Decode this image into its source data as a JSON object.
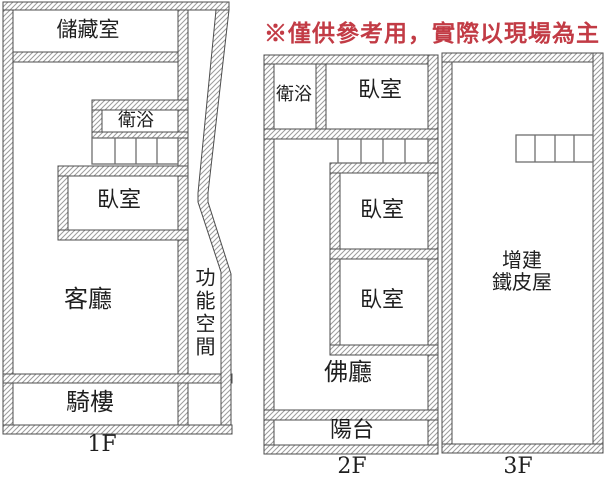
{
  "disclaimer": {
    "text": "※僅供參考用，實際以現場為主",
    "color": "#C23B45"
  },
  "colors": {
    "wall_outline": "#4d4d4d",
    "wall_hatch": "#9c9c9c",
    "stair_line": "#6e6e6e",
    "label_text": "#1f1f1f",
    "background": "#ffffff"
  },
  "floors": [
    {
      "label": "1F",
      "rooms": {
        "storage": "儲藏室",
        "bathroom": "衛浴",
        "bedroom": "臥室",
        "living": "客廳",
        "functional": "功能空間",
        "arcade": "騎樓"
      }
    },
    {
      "label": "2F",
      "rooms": {
        "bathroom": "衛浴",
        "bedroom_top": "臥室",
        "bedroom_mid": "臥室",
        "bedroom_low": "臥室",
        "buddha": "佛廳",
        "balcony": "陽台"
      }
    },
    {
      "label": "3F",
      "rooms": {
        "annex": "增建\n鐵皮屋"
      }
    }
  ]
}
